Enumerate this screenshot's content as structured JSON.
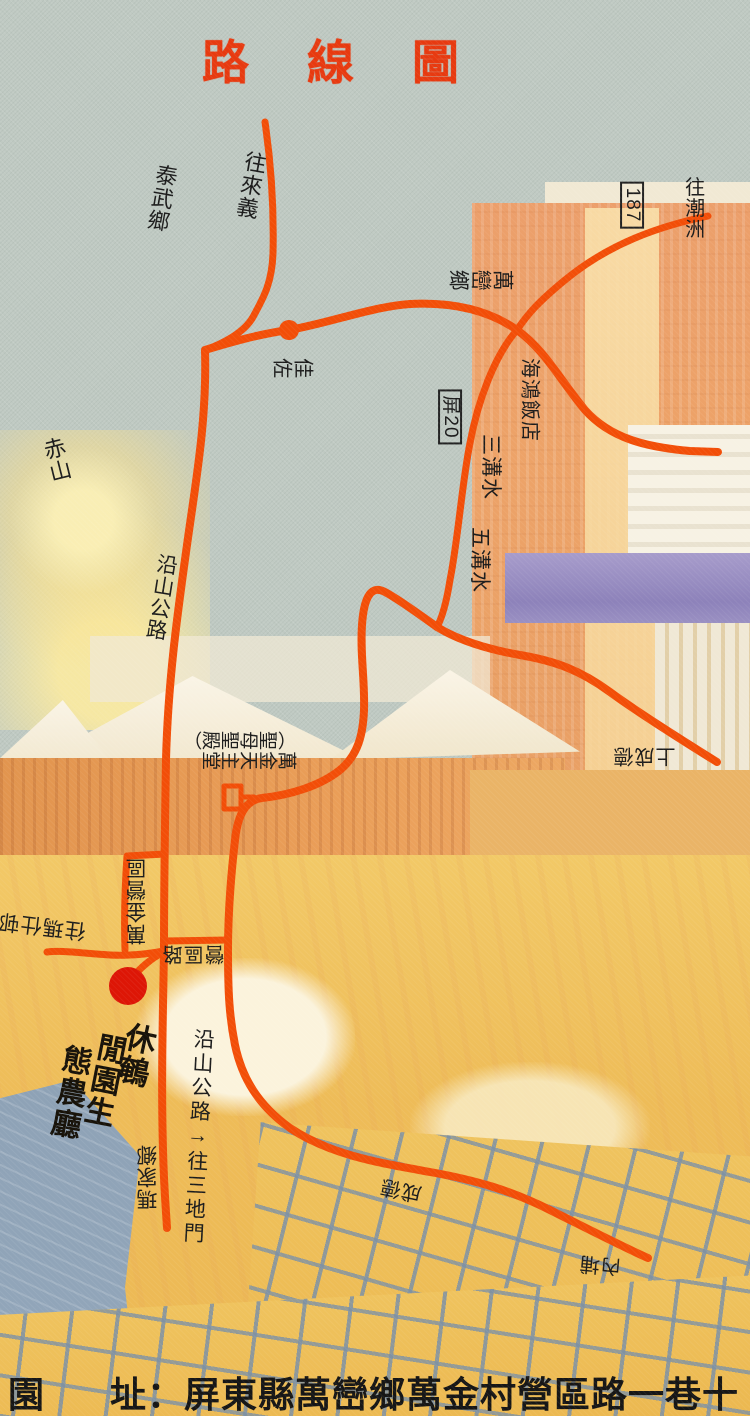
{
  "title": "路線圖",
  "colors": {
    "road_orange": "#f24e08",
    "marker_red": "#dd1606",
    "title_red": "#e73a10",
    "label_black": "#1c1c1c"
  },
  "labels": {
    "wang_laiyi": "往來義",
    "taiwu_township": "泰武鄉",
    "wang_chaozhou": "往潮洲",
    "route_187": "187",
    "wanluan_township": "萬巒鄉",
    "jiazuo": "佳佐",
    "haihong_hotel": "海鴻飯店",
    "ping_20": "屏20",
    "sangou_water": "三溝水",
    "wugou_water": "五溝水",
    "chishan": "赤山",
    "yanshan_highway": "沿山公路",
    "shang_chengde": "上成德",
    "wanjin_camp": "萬金營區",
    "yingqu_road": "營區路",
    "wang_mashi": "往瑪仕邨",
    "yanshan_to_sandimen": "沿山公路→往三地門",
    "majia_township": "瑪家鄉",
    "chengde": "成德",
    "neipu": "內埔"
  },
  "church": {
    "name": "萬金天主堂",
    "subtitle": "（聖母聖殿）"
  },
  "destination": {
    "name": "鵪園休閒生態農廳",
    "col_right": "休鵪",
    "col_mid": "閒園生",
    "col_left": "態農廳"
  },
  "address": {
    "prefix": "園",
    "body": "址：屏東縣萬巒鄉萬金村營區路一巷十號"
  }
}
